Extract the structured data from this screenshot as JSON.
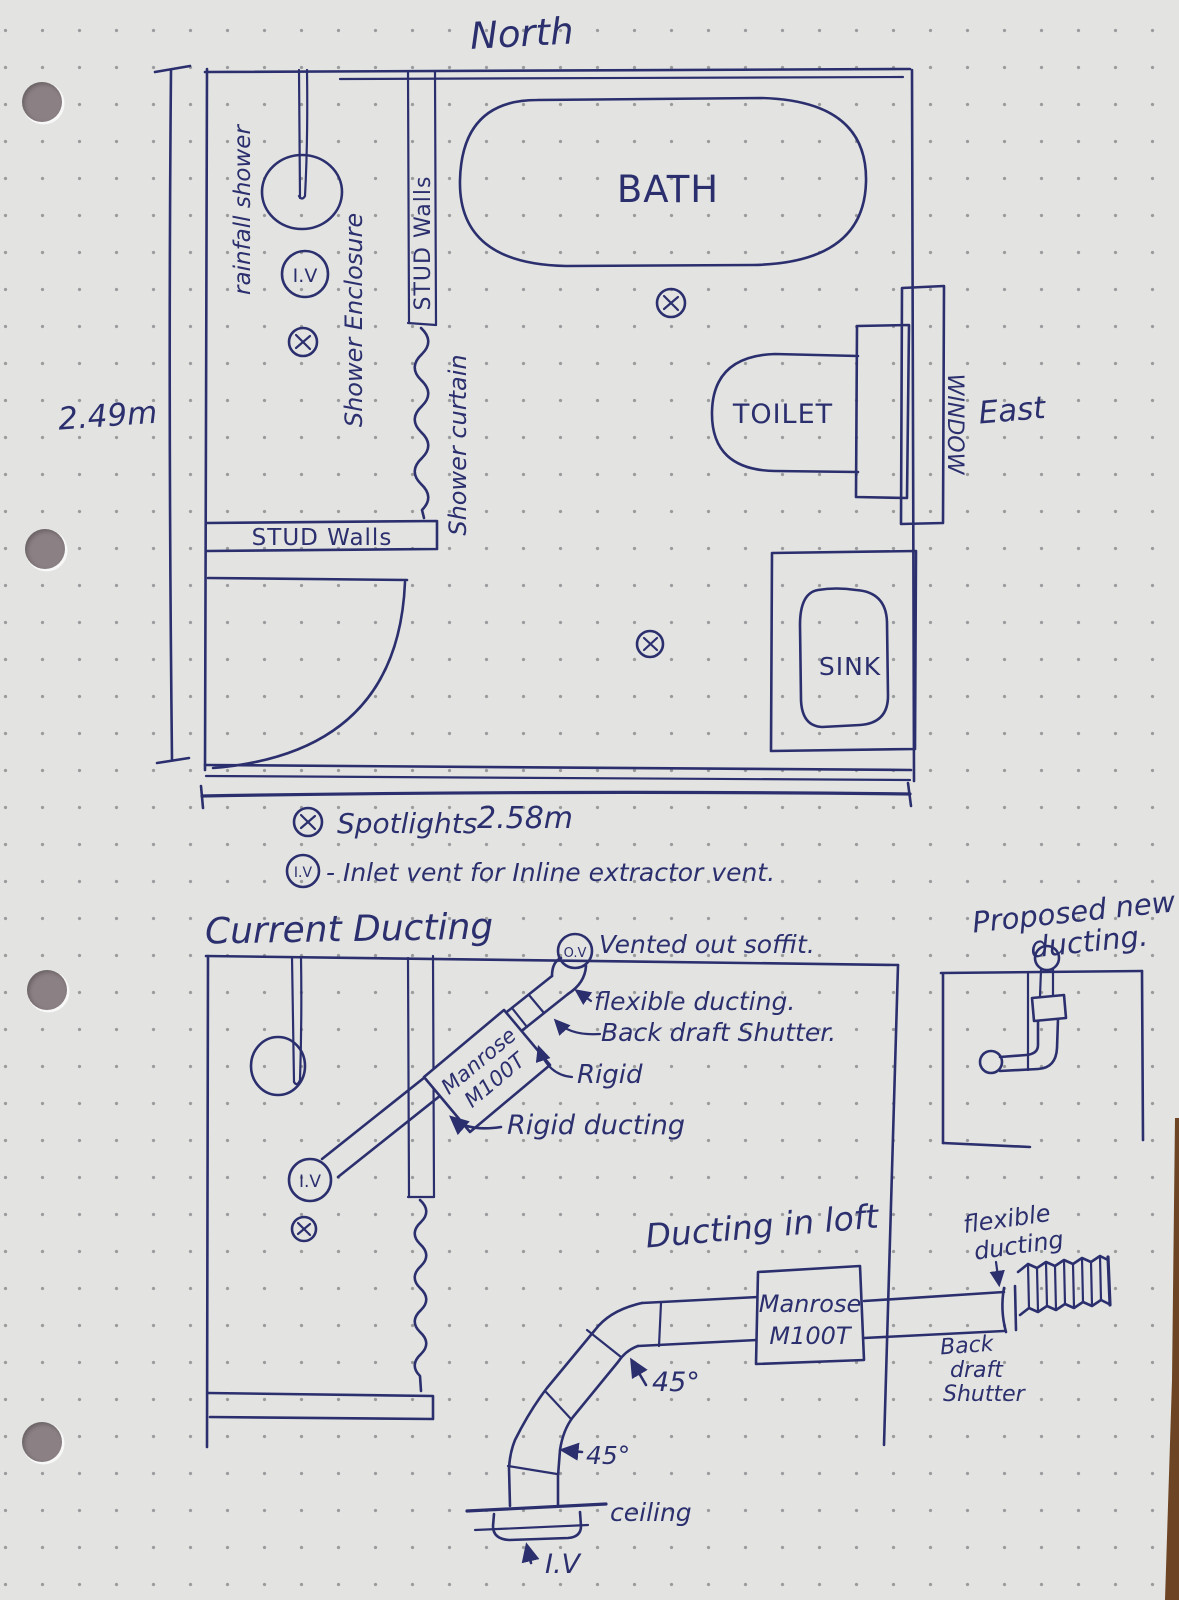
{
  "page": {
    "type": "hand-drawn bathroom plan and extractor ducting sketch",
    "ink_color": "#2b2f6e",
    "paper_color": "#e3e4e1"
  },
  "floor_plan": {
    "north": "North",
    "height_dim": "2.49m",
    "width_dim": "2.58m",
    "rainfall_shower": "rainfall shower",
    "shower_enclosure": "Shower Enclosure",
    "stud_walls_vertical": "STUD Walls",
    "stud_walls_horizontal": "STUD Walls",
    "shower_curtain": "Shower curtain",
    "bath": "BATH",
    "toilet": "TOILET",
    "sink": "SINK",
    "window": "WINDOW",
    "east": "East",
    "inlet_vent": "I.V"
  },
  "legend": {
    "spotlights": "Spotlights",
    "iv": "I.V",
    "iv_description": "- Inlet vent for Inline extractor vent."
  },
  "current_ducting": {
    "title": "Current Ducting",
    "outlet_vent": "O.V",
    "vented_out": "Vented out soffit.",
    "flexible_ducting": "flexible ducting.",
    "back_draft_shutter": "Back draft Shutter.",
    "rigid": "Rigid",
    "rigid_ducting": "Rigid ducting",
    "inlet_vent": "I.V",
    "fan_line1": "Manrose",
    "fan_line2": "M100T"
  },
  "proposed_ducting": {
    "title_line1": "Proposed new",
    "title_line2": "ducting."
  },
  "loft_ducting": {
    "title": "Ducting in loft",
    "fan_line1": "Manrose",
    "fan_line2": "M100T",
    "flexible_line1": "flexible",
    "flexible_line2": "ducting",
    "back_draft_line1": "Back",
    "back_draft_line2": "draft",
    "back_draft_line3": "Shutter",
    "angle1": "45°",
    "angle2": "45°",
    "ceiling": "ceiling",
    "inlet_vent": "I.V"
  }
}
